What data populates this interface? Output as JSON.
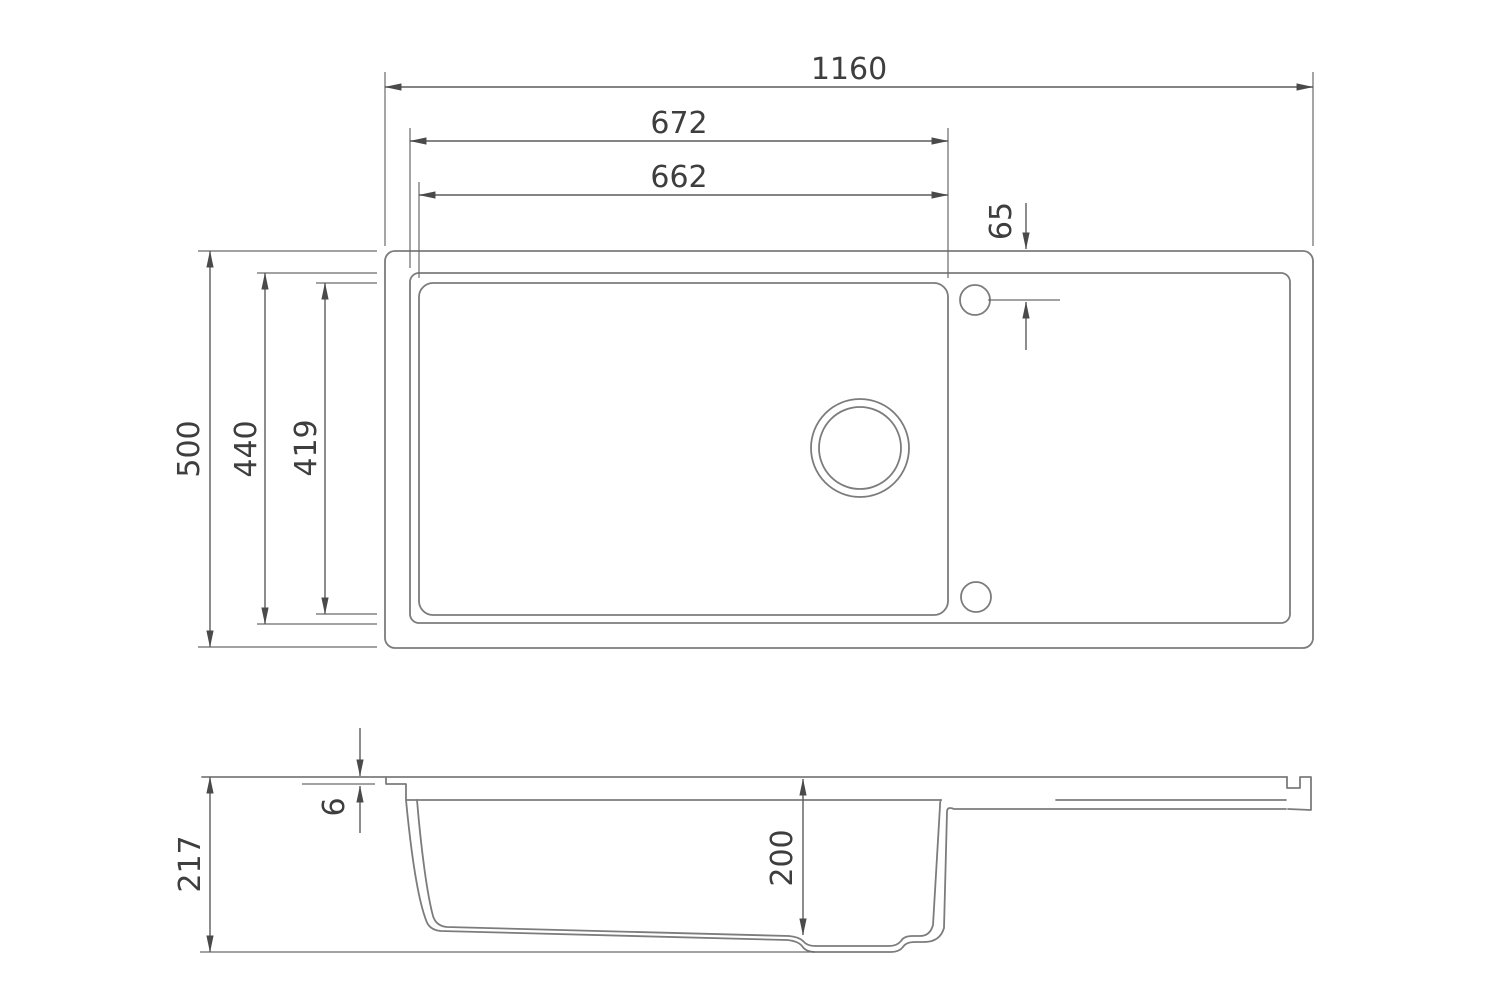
{
  "drawing": {
    "subject": "kitchen-sink-dimension-drawing",
    "units": "mm",
    "colors": {
      "background": "#ffffff",
      "geometry_line": "#7c7c7c",
      "dimension_line": "#5c5c5c",
      "text": "#3e3e3e"
    },
    "top_view": {
      "dims": {
        "overall_width": "1160",
        "bowl_cutout_width": "672",
        "bowl_inner_width": "662",
        "tap_hole_offset": "65",
        "overall_depth": "500",
        "bowl_cutout_depth": "440",
        "bowl_inner_depth": "419"
      }
    },
    "side_view": {
      "dims": {
        "overall_height": "217",
        "rim_lip_height": "6",
        "bowl_depth": "200"
      }
    }
  }
}
